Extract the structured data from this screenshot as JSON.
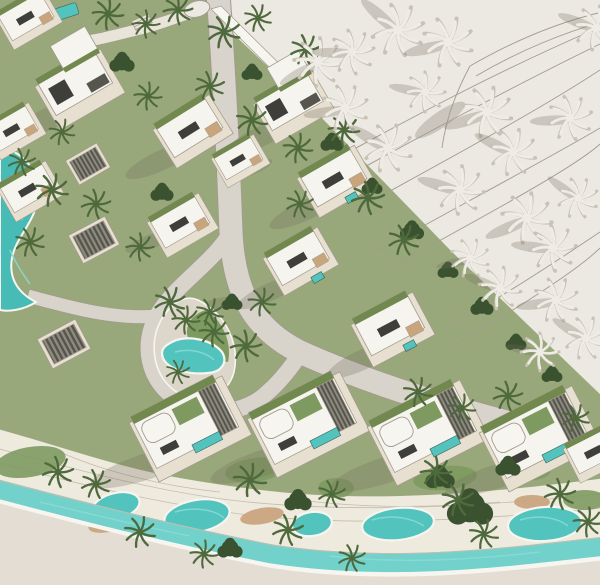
{
  "scene": {
    "type": "architectural-aerial-render",
    "subject": "master-planned villa community with pools, lagoon canal and palm trees; unbuilt sand area with white clay palms at top right",
    "colors": {
      "ground": "#e8e3db",
      "ground2": "#ece8e2",
      "ground3": "#e4ddd3",
      "lawn": "#98a87a",
      "lawn2": "#7e9a60",
      "hedge": "#4c663c",
      "road": "#d8d4cb",
      "road2": "#e9e4da",
      "terrace": "#efeade",
      "line": "#a39b8d",
      "line2": "#c4bcae",
      "roof": "#f6f4ef",
      "wallc": "#e7dfd0",
      "dark": "#3e3e3a",
      "dark2": "#56564f",
      "greenroof": "#71894f",
      "wood": "#c9a57e",
      "pool": "#52c3bd",
      "poollight": "#8adcd5",
      "canal": "#72d1ca",
      "lagoon": "#47bcb6",
      "palm": "#4e6a3c",
      "palmdark": "#3a5230",
      "palmw": "#efece6",
      "palmwsh": "#c9c2b5",
      "shadow": "rgba(115,107,92,0.28)",
      "white": "#f7f5f0"
    },
    "inventory": {
      "villas": 18,
      "pergola_pavilions": 3,
      "organic_ponds": 5,
      "lagoon_pool": 1,
      "island_pond": 1,
      "canal": 1,
      "roundabout": 1,
      "green_palms": 44,
      "white_clay_palms": 20,
      "tree_clumps": 16
    }
  }
}
